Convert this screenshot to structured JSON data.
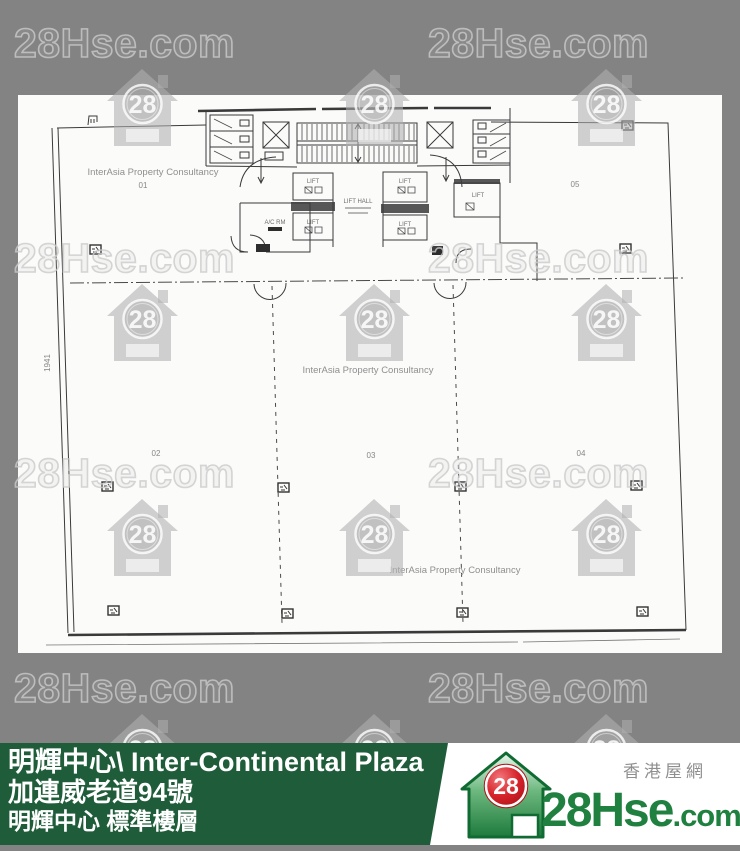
{
  "watermark": {
    "text": "28Hse.com",
    "badge": "28"
  },
  "plan": {
    "consultancy": "InterAsia Property Consultancy",
    "units": {
      "u01": "01",
      "u02": "02",
      "u03": "03",
      "u04": "04",
      "u05": "05"
    },
    "lift_hall": "LIFT HALL",
    "lift": "LIFT",
    "ac_room": "A/C RM",
    "dim_left": "1941"
  },
  "banner": {
    "title": "明輝中心\\ Inter-Continental Plaza",
    "address": "加連威老道94號",
    "floor": "明輝中心 標準樓層"
  },
  "logo": {
    "badge": "28",
    "brand": "28Hse",
    "tld": ".com",
    "tagline": "香港屋網"
  },
  "colors": {
    "background": "#838383",
    "banner_green": "#1f5c39",
    "logo_green": "#1f8040",
    "logo_red": "#cf1e26",
    "watermark_gray": "#ababab"
  }
}
